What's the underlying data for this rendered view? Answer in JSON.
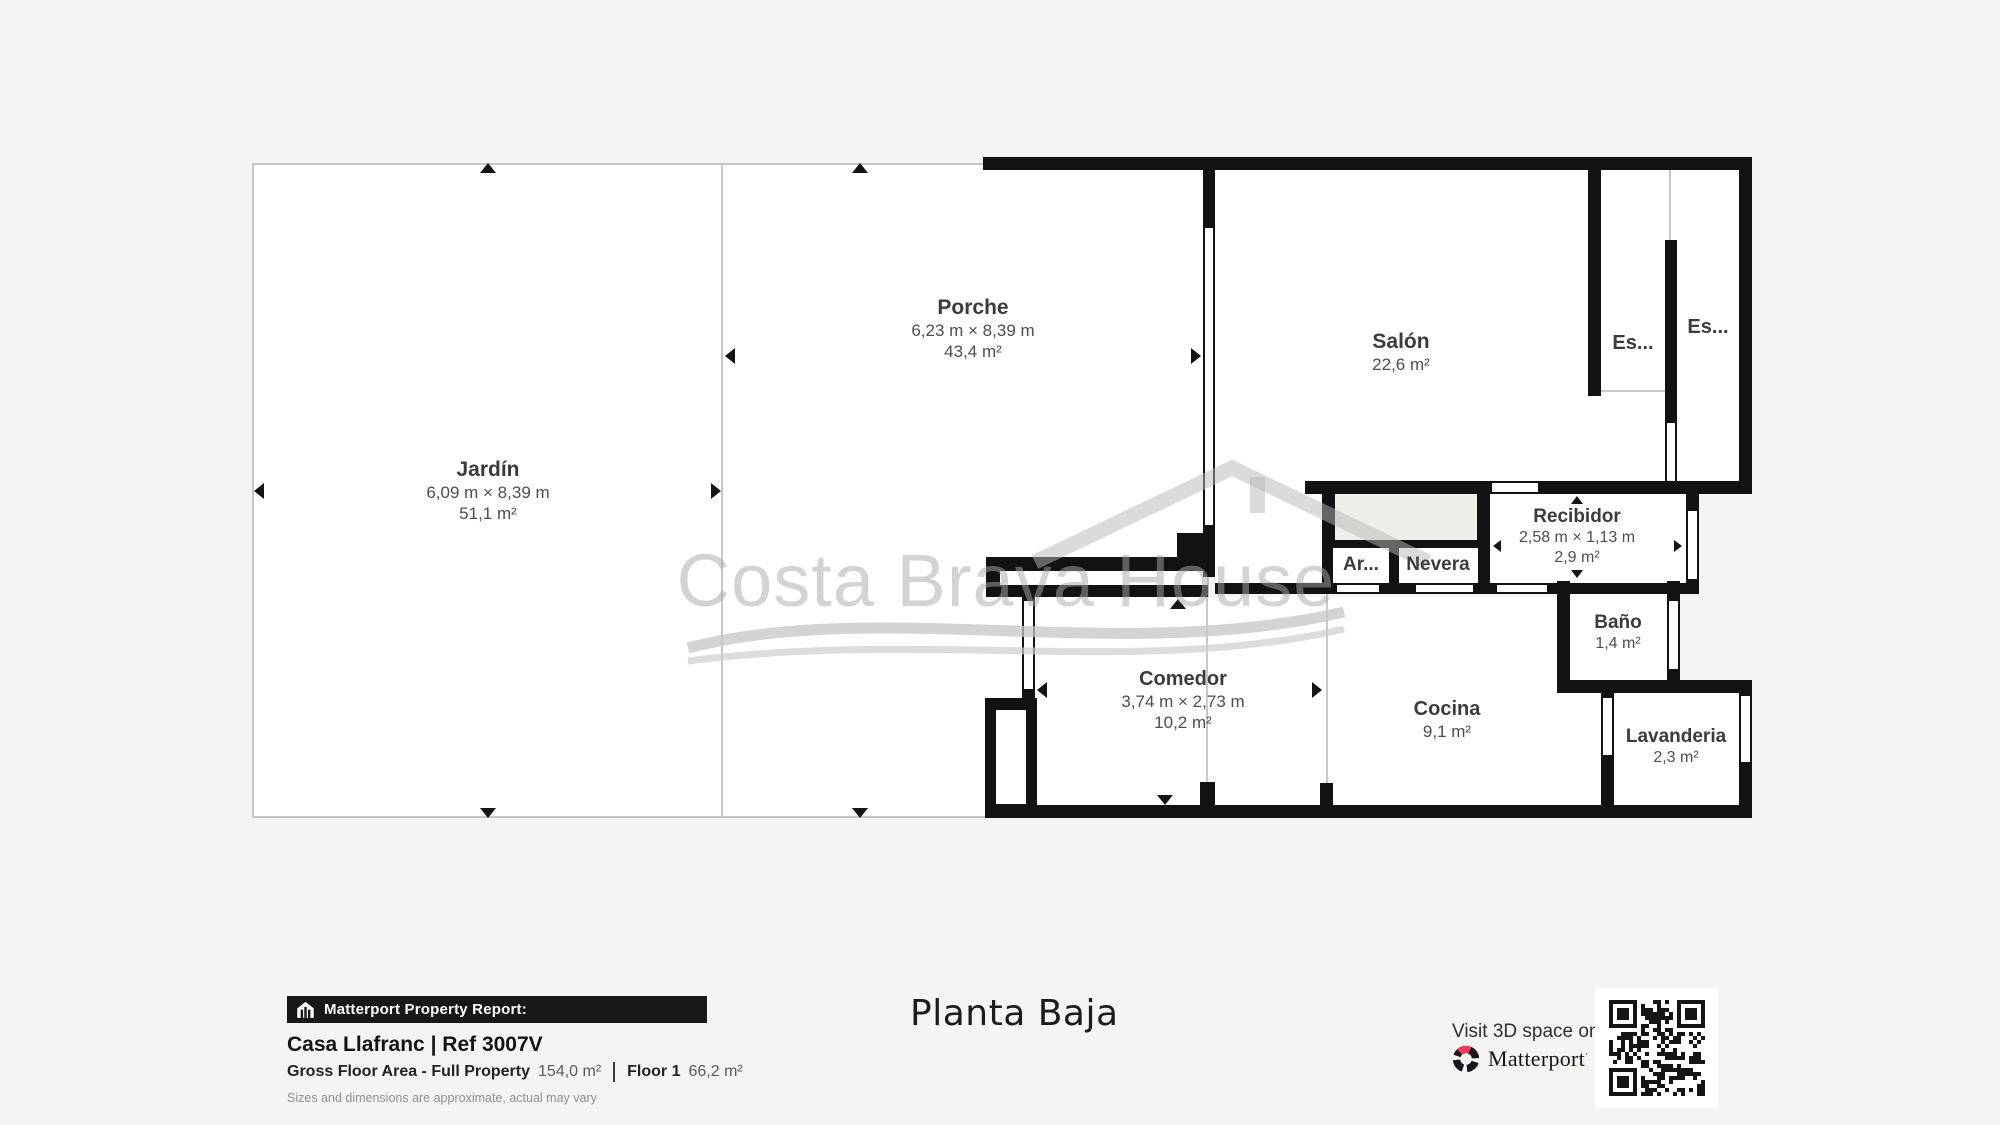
{
  "colors": {
    "background": "#f5f4f2",
    "wall": "#121212",
    "outdoor_border": "#c6c6c4",
    "watermark_gray": "#a9a9a7",
    "matterport_pink": "#f43a5c"
  },
  "watermark": {
    "text": "Costa Brava House"
  },
  "rooms": {
    "jardin": {
      "name": "Jardín",
      "dims": "6,09 m × 8,39 m",
      "area": "51,1 m²"
    },
    "porche": {
      "name": "Porche",
      "dims": "6,23 m × 8,39 m",
      "area": "43,4 m²"
    },
    "salon": {
      "name": "Salón",
      "area": "22,6 m²"
    },
    "escalera1": {
      "name": "Es..."
    },
    "escalera2": {
      "name": "Es..."
    },
    "armario": {
      "name": "Ar..."
    },
    "nevera": {
      "name": "Nevera"
    },
    "recibidor": {
      "name": "Recibidor",
      "dims": "2,58 m × 1,13 m",
      "area": "2,9 m²"
    },
    "bano": {
      "name": "Baño",
      "area": "1,4 m²"
    },
    "comedor": {
      "name": "Comedor",
      "dims": "3,74 m × 2,73 m",
      "area": "10,2 m²"
    },
    "cocina": {
      "name": "Cocina",
      "area": "9,1 m²"
    },
    "lavanderia": {
      "name": "Lavanderia",
      "area": "2,3 m²"
    }
  },
  "footer": {
    "report_badge": "Matterport Property Report:",
    "property_title": "Casa Llafranc | Ref 3007V",
    "gfa_label": "Gross Floor Area - Full Property",
    "gfa_value": "154,0 m²",
    "floor_label": "Floor 1",
    "floor_value": "66,2 m²",
    "disclaimer": "Sizes and dimensions are approximate, actual may vary",
    "plan_title": "Planta Baja",
    "visit_text": "Visit 3D space on",
    "matterport_wordmark": "Matterport"
  },
  "icons": {
    "report_badge": "house-report-icon",
    "logo": "matterport-loop-icon",
    "qr": "qr-code"
  }
}
